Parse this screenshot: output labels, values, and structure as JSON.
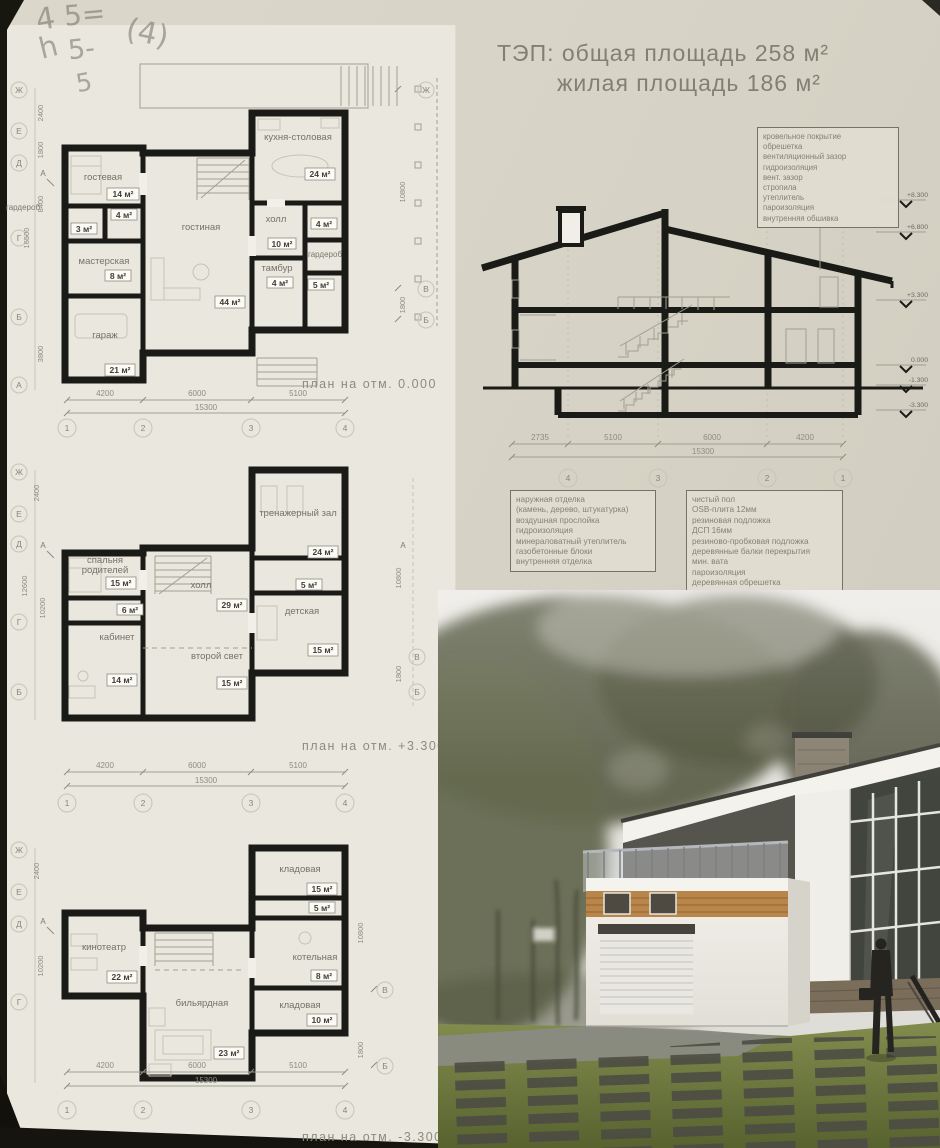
{
  "handwriting": [
    "4",
    "5=",
    "(4)",
    "h",
    "5-",
    "5"
  ],
  "tep": {
    "line1": "ТЭП: общая площадь 258 м²",
    "line2": "жилая площадь 186 м²"
  },
  "plans": [
    {
      "caption": "план на отм. 0.000",
      "rooms": [
        {
          "name": "гостевая",
          "area": "14 м²"
        },
        {
          "name": "",
          "area": "4 м²"
        },
        {
          "name": "",
          "area": "3 м²"
        },
        {
          "name": "мастерская",
          "area": "8 м²"
        },
        {
          "name": "гараж",
          "area": "21 м²"
        },
        {
          "name": "гостиная",
          "area": "44 м²"
        },
        {
          "name": "кухня-столовая",
          "area": "24 м²"
        },
        {
          "name": "холл",
          "area": "10 м²"
        },
        {
          "name": "",
          "area": "4 м²"
        },
        {
          "name": "гардероб",
          "area": ""
        },
        {
          "name": "тамбур",
          "area": "4 м²"
        },
        {
          "name": "",
          "area": "5 м²"
        },
        {
          "name": "гардероб",
          "area": ""
        }
      ],
      "dims": [
        "4200",
        "6000",
        "5100"
      ],
      "total": "15300",
      "axes": [
        "1",
        "2",
        "3",
        "4"
      ],
      "axes_left": [
        "Ж",
        "Е",
        "Д",
        "Г",
        "Б",
        "А"
      ],
      "dims_left": [
        "2400",
        "1800",
        "8400",
        "16500",
        "3800"
      ],
      "axes_right": [
        "Ж",
        "В",
        "Б"
      ],
      "dims_right": [
        "10800",
        "1800"
      ],
      "marker": "А"
    },
    {
      "caption": "план на отм. +3.300",
      "rooms": [
        {
          "name": "тренажерный зал",
          "area": "24 м²"
        },
        {
          "name": "спальня",
          "name2": "родителей",
          "area": "15 м²"
        },
        {
          "name": "",
          "area": "6 м²"
        },
        {
          "name": "кабинет",
          "area": "14 м²"
        },
        {
          "name": "холл",
          "area": "29 м²"
        },
        {
          "name": "второй свет",
          "area": "15 м²"
        },
        {
          "name": "детская",
          "area": "15 м²"
        },
        {
          "name": "",
          "area": "5 м²"
        }
      ],
      "dims": [
        "4200",
        "6000",
        "5100"
      ],
      "total": "15300",
      "axes": [
        "1",
        "2",
        "3",
        "4"
      ],
      "axes_left": [
        "Ж",
        "Е",
        "Д",
        "Г",
        "Б"
      ],
      "dims_left": [
        "2400",
        "12600",
        "10200"
      ],
      "axes_right": [
        "В",
        "Б"
      ],
      "dims_right": [
        "10800",
        "1800"
      ],
      "marker": "А"
    },
    {
      "caption": "план на отм. -3.300",
      "rooms": [
        {
          "name": "кладовая",
          "area": "15 м²"
        },
        {
          "name": "",
          "area": "5 м²"
        },
        {
          "name": "кинотеатр",
          "area": "22 м²"
        },
        {
          "name": "котельная",
          "area": "8 м²"
        },
        {
          "name": "кладовая",
          "area": "10 м²"
        },
        {
          "name": "бильярдная",
          "area": "23 м²"
        }
      ],
      "dims": [
        "4200",
        "6000",
        "5100"
      ],
      "total": "15300",
      "axes": [
        "1",
        "2",
        "3",
        "4"
      ],
      "axes_left": [
        "Ж",
        "Е",
        "Д",
        "Г"
      ],
      "dims_left": [
        "2400",
        "10200"
      ],
      "axes_right": [
        "В",
        "Б"
      ],
      "dims_right": [
        "10800",
        "1800"
      ],
      "marker": "А"
    }
  ],
  "section": {
    "roof_spec": [
      "кровельное покрытие",
      "обрешетка",
      "вентиляционный зазор",
      "гидроизоляция",
      "вент. зазор",
      "стропила",
      "утеплитель",
      "пароизоляция",
      "внутренняя обшивка"
    ],
    "wall_spec": [
      "наружная отделка",
      "(камень, дерево, штукатурка)",
      "воздушная прослойка",
      "гидроизоляция",
      "минераловатный утеплитель",
      "газобетонные блоки",
      "внутренняя отделка"
    ],
    "floor_spec": [
      "чистый пол",
      "OSB-плита 12мм",
      "резиновая подложка",
      "ДСП 16мм",
      "резиново-пробковая подложка",
      "деревянные балки перекрытия",
      "мин. вата",
      "пароизоляция",
      "деревянная обрешетка",
      "лист гипсокартона"
    ],
    "levels": [
      "+8.300",
      "+6.800",
      "+3.300",
      "0.000",
      "-1.300",
      "-3.300"
    ],
    "dims": [
      "2735",
      "5100",
      "6000",
      "4200"
    ],
    "total": "15300",
    "axes": [
      "4",
      "3",
      "2",
      "1"
    ]
  },
  "colors": {
    "paper": "#dbd7cb",
    "sheet": "#e9e7de",
    "ink": "#1a1a17",
    "lawn": "#727c42",
    "wood_band": "#b8854a",
    "tree": "#5e614b",
    "glass": "#41453e"
  }
}
